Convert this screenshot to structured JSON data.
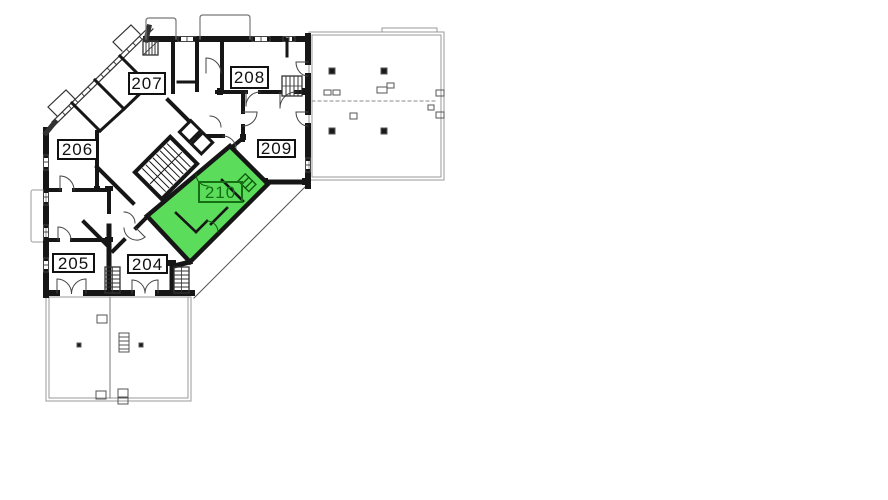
{
  "floorplan": {
    "kind": "building-floor-plan",
    "highlighted_unit": "210",
    "colors": {
      "background": "#ffffff",
      "linework": "#161616",
      "terrace_line": "#9a9a9a",
      "highlight_fill": "#5bdd5b",
      "highlight_label": "#157015"
    },
    "units": [
      {
        "label": "204",
        "highlighted": false
      },
      {
        "label": "205",
        "highlighted": false
      },
      {
        "label": "206",
        "highlighted": false
      },
      {
        "label": "207",
        "highlighted": false
      },
      {
        "label": "208",
        "highlighted": false
      },
      {
        "label": "209",
        "highlighted": false
      },
      {
        "label": "210",
        "highlighted": true
      }
    ]
  }
}
